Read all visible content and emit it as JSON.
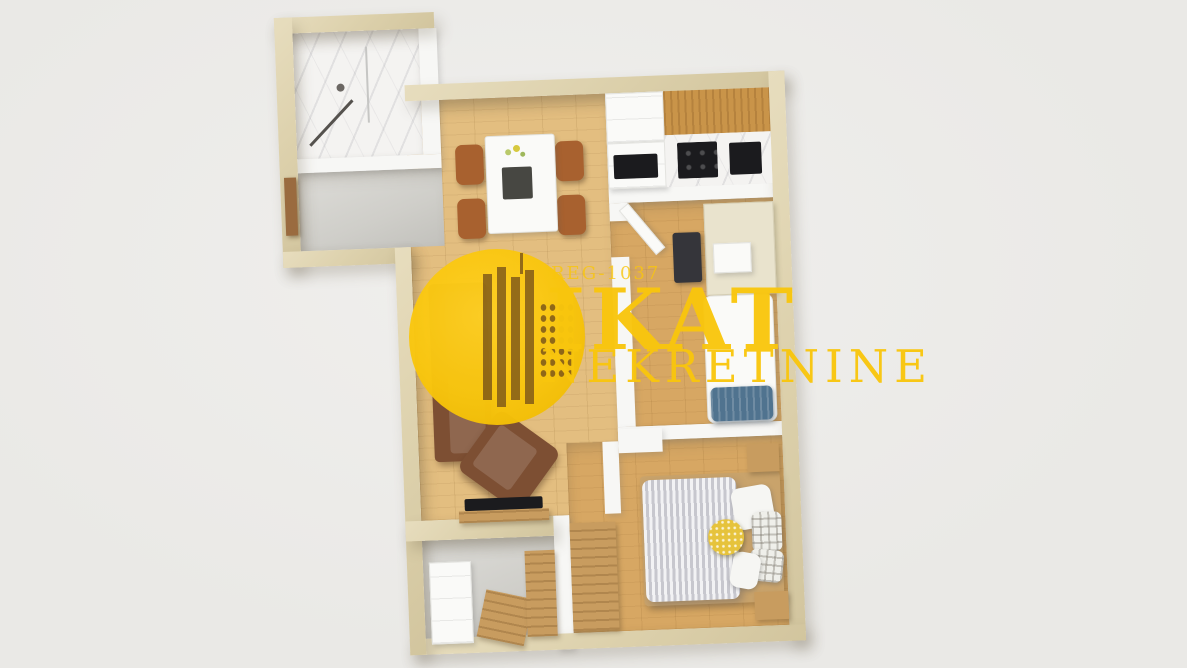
{
  "scene": {
    "title": "3D top-down floor plan render of a one-bedroom apartment"
  },
  "watermark": {
    "registration": "REG-1037",
    "brand": "IKAT",
    "subtitle": "NEKRETNINE",
    "logo_icon": "city-skyline-icon",
    "color": "#F9C60D"
  },
  "colors": {
    "background": "#EAE9E6",
    "background_hi": "#F0EFED",
    "wall": "#DCD0AB",
    "wall_hi": "#E7DDBE",
    "wall_inner": "#F7F7F5",
    "wood_light": "#E3BE80",
    "wood_mid": "#D7A763",
    "wood_furniture": "#C89C5F",
    "marble": "#F4F3F1",
    "tile_gray": "#CFCEC9",
    "sofa": "#7D4F33",
    "chair": "#A8612F",
    "duvet": "#C7C7CE",
    "pillow_blue": "#50738F",
    "pillow_yellow": "#E6C33C",
    "appliance": "#1B1B1E",
    "watermark": "#F9C60D"
  }
}
